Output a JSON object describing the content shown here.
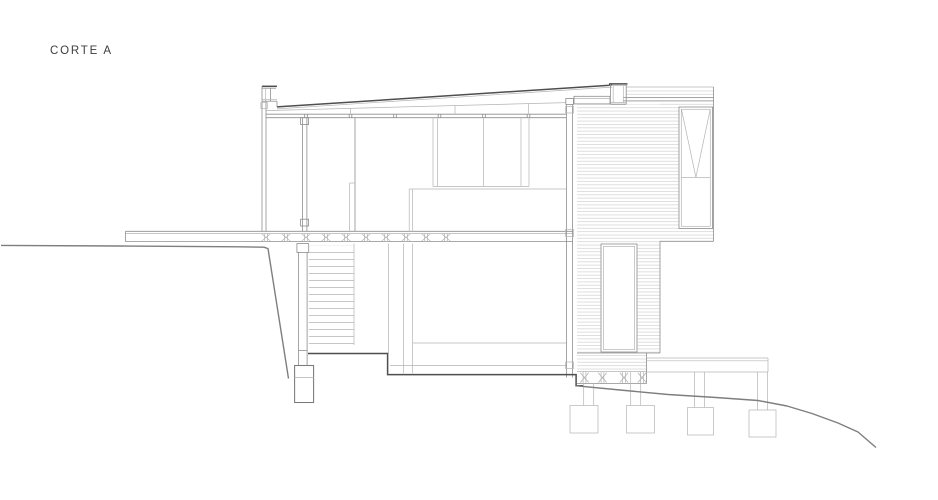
{
  "drawing": {
    "title": "CORTE A",
    "type": "architectural-section",
    "colors": {
      "background": "#ffffff",
      "cut_line": "#4e4e4e",
      "wall_line": "#8d8d8d",
      "detail_line": "#b4b4b4",
      "siding_line": "#c9c9c9",
      "ground_line": "#7e7e7e",
      "text": "#3d3d3d"
    }
  }
}
